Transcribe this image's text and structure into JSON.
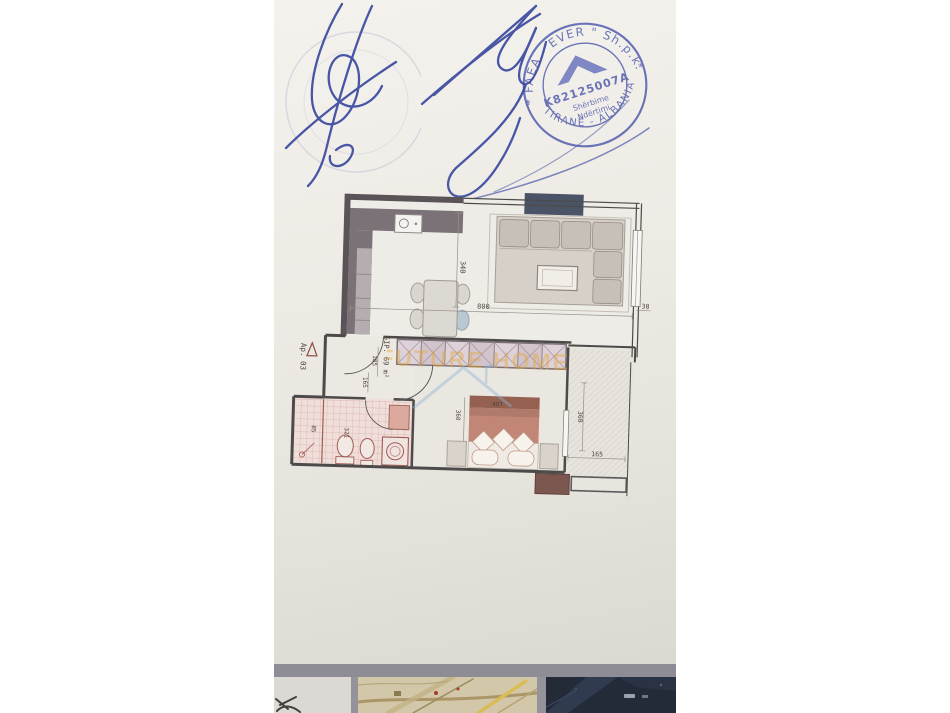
{
  "photo": {
    "stamp": {
      "top_arc": "\" FAEA - EVER \" Sh.p.k.",
      "registration_code": "K82125007A",
      "service_line1": "Shërbime",
      "service_line2": "Ndërtimi",
      "bottom_arc": "TIRANË - ALBANIA",
      "star_left": "*",
      "star_right": "*",
      "ink_color": "#4d58ac"
    },
    "watermark": {
      "text": "FUTURE HOME",
      "color": "#e2a52e"
    },
    "floor_plan": {
      "apartment_label": "Ap. 03",
      "area_label": "SIP. 69 m²",
      "dims": {
        "living_height": "340",
        "living_width": "800",
        "wall_right": "30",
        "entry_a": "185",
        "entry_b": "165",
        "bath_a": "85",
        "bath_b": "321",
        "bedroom_height": "360",
        "bed_width": "407",
        "balcony_height": "360",
        "balcony_width": "165"
      }
    }
  }
}
